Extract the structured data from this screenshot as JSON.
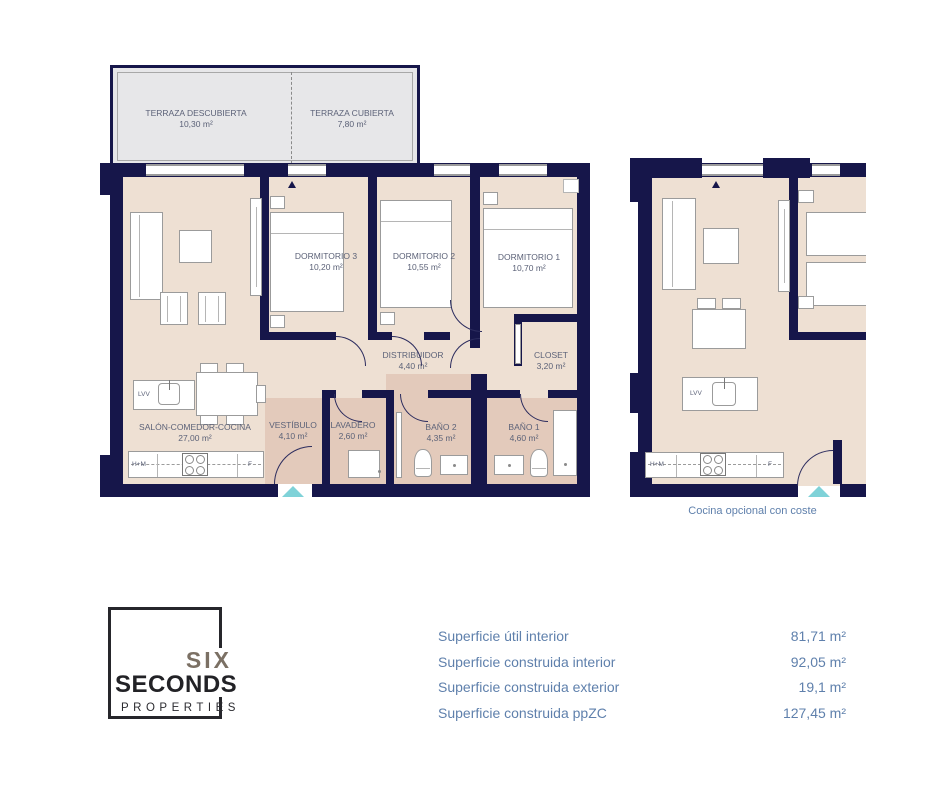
{
  "terrace": {
    "rooms": [
      {
        "name": "TERRAZA DESCUBIERTA",
        "area": "10,30 m²"
      },
      {
        "name": "TERRAZA CUBIERTA",
        "area": "7,80 m²"
      }
    ]
  },
  "main_plan": {
    "rooms": {
      "dormitorio3": {
        "name": "DORMITORIO 3",
        "area": "10,20 m²"
      },
      "dormitorio2": {
        "name": "DORMITORIO 2",
        "area": "10,55 m²"
      },
      "dormitorio1": {
        "name": "DORMITORIO 1",
        "area": "10,70 m²"
      },
      "distribuidor": {
        "name": "DISTRIBUIDOR",
        "area": "4,40 m²"
      },
      "closet": {
        "name": "CLOSET",
        "area": "3,20 m²"
      },
      "salon": {
        "name": "SALÓN-COMEDOR-COCINA",
        "area": "27,00 m²"
      },
      "vestibulo": {
        "name": "VESTÍBULO",
        "area": "4,10 m²"
      },
      "lavadero": {
        "name": "LAVADERO",
        "area": "2,60 m²"
      },
      "bano2": {
        "name": "BAÑO 2",
        "area": "4,35 m²"
      },
      "bano1": {
        "name": "BAÑO 1",
        "area": "4,60 m²"
      }
    }
  },
  "appliances": {
    "dishwasher": "LVV",
    "oven_micro": "H+M",
    "fridge": "F"
  },
  "alt_plan": {
    "caption": "Cocina opcional con coste"
  },
  "logo": {
    "word1": "SIX",
    "word2": "SECONDS",
    "word3": "PROPERTIES"
  },
  "surface_table": {
    "rows": [
      {
        "label": "Superficie útil interior",
        "value": "81,71 m²"
      },
      {
        "label": "Superficie construida interior",
        "value": "92,05 m²"
      },
      {
        "label": "Superficie construida exterior",
        "value": "19,1 m²"
      },
      {
        "label": "Superficie construida ppZC",
        "value": "127,45 m²"
      }
    ]
  },
  "colors": {
    "wall": "#16164a",
    "floor": "#eee0d3",
    "wet_floor": "#e3cabb",
    "terrace": "#e7e7e9",
    "accent_teal": "#7fd2d8",
    "room_label": "#5c6278",
    "info_text": "#5f80ac"
  }
}
